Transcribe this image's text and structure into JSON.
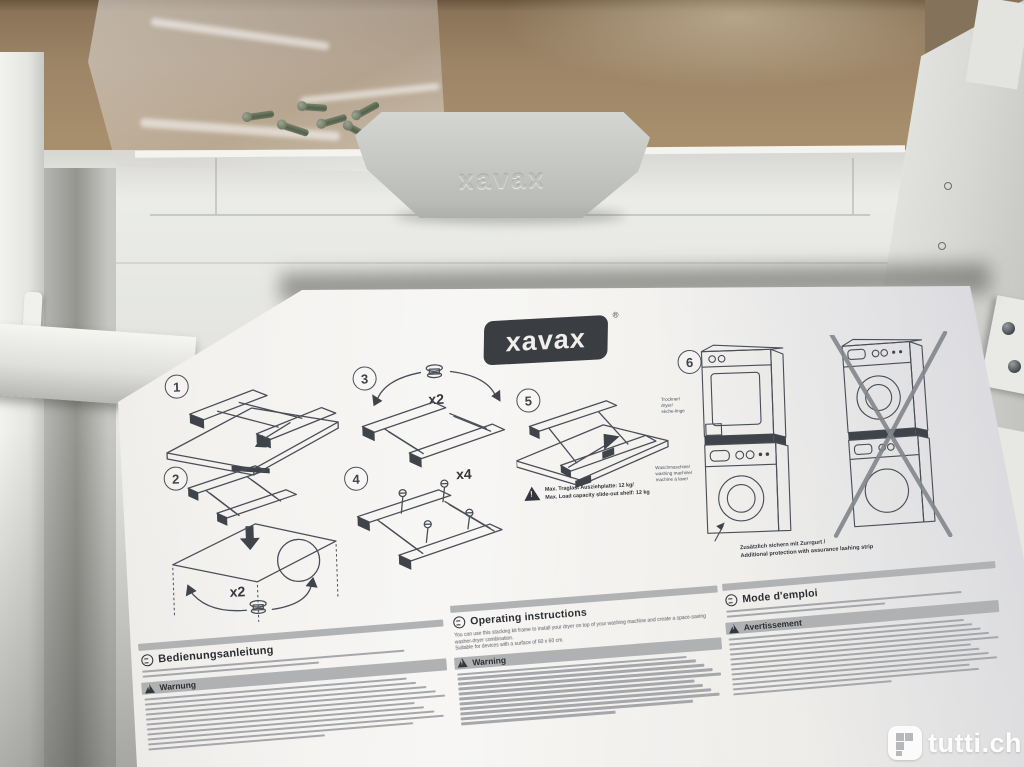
{
  "brand": {
    "logo_text": "xavax",
    "registered": "®",
    "handle_embossed": "xavax"
  },
  "diagram": {
    "step_numbers": [
      "1",
      "2",
      "3",
      "4",
      "5",
      "6"
    ],
    "qty_step2": "x2",
    "qty_step3": "x2",
    "qty_step4": "x4",
    "max_load_line1": "Max. Traglast Ausziehplatte: 12 kg/",
    "max_load_line2": "Max. Load capacity slide-out shelf: 12 kg",
    "label_dryer_l1": "Trockner/",
    "label_dryer_l2": "dryer/",
    "label_dryer_l3": "sèche-linge",
    "label_washer_l1": "Waschmaschine/",
    "label_washer_l2": "washing machine/",
    "label_washer_l3": "machine à laver",
    "strap_line1": "Zusätzlich sichern mit Zurrgurt /",
    "strap_line2": "Additional protection with assurance lashing strip"
  },
  "sections": {
    "de": {
      "title": "Bedienungsanleitung",
      "warning": "Warnung"
    },
    "en": {
      "title": "Operating instructions",
      "warning": "Warning",
      "intro1": "You can use this stacking kit frame to install your dryer on top of your washing machine and create a space-saving washer-dryer combination.",
      "intro2": "Suitable for devices with a surface of 60 x 60 cm."
    },
    "fr": {
      "title": "Mode d'emploi",
      "warning": "Avertissement"
    }
  },
  "watermark": {
    "text": "tutti.ch"
  },
  "colors": {
    "cardboard": "#a18a68",
    "product_white": "#e9eae6",
    "handle_gray": "#c6c8c4",
    "paper": "#f2f1ee",
    "line_art": "#4a4f57",
    "header_bar": "#b0b2b4",
    "watermark_white": "#ffffff"
  }
}
